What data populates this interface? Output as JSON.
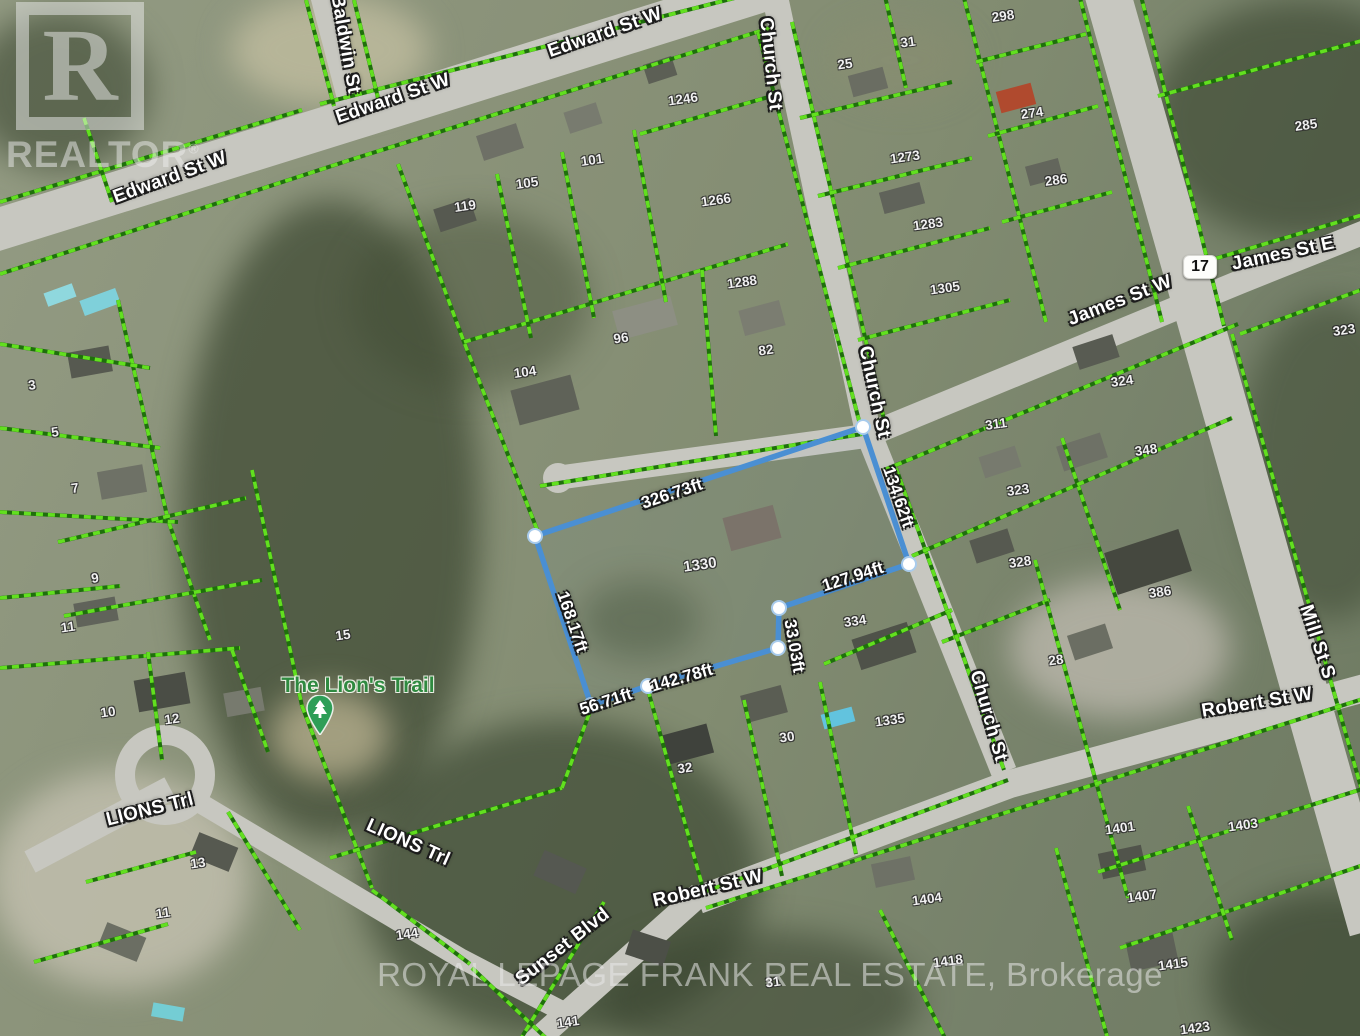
{
  "canvas": {
    "width": 1360,
    "height": 1036
  },
  "colors": {
    "parcel_line_bright": "#62e01f",
    "parcel_line_dark": "#1f6f0c",
    "property_blue": "#4a8fd3",
    "vertex_fill": "#ffffff",
    "vertex_ring": "#a8cbec",
    "road": "#c7c7c0",
    "poi_green": "#2f8a40",
    "pin_green": "#2e9e57"
  },
  "watermarks": {
    "realtor_word": "REALTOR",
    "realtor_reg": "®",
    "realtor_glyph": "R",
    "brokerage_line": "ROYAL LEPAGE FRANK REAL ESTATE, Brokerage"
  },
  "highway_badge": {
    "text": "17",
    "x": 1200,
    "y": 267
  },
  "poi": {
    "label": "The Lion's Trail",
    "x": 358,
    "y": 686,
    "pin_x": 320,
    "pin_y": 740
  },
  "streets": [
    {
      "text": "Edward St W",
      "x": 605,
      "y": 33,
      "rot": -19
    },
    {
      "text": "Edward St W",
      "x": 393,
      "y": 99,
      "rot": -19
    },
    {
      "text": "Edward St W",
      "x": 170,
      "y": 178,
      "rot": -20
    },
    {
      "text": "Baldwin St",
      "x": 345,
      "y": 44,
      "rot": 80
    },
    {
      "text": "Church St",
      "x": 770,
      "y": 64,
      "rot": 84
    },
    {
      "text": "Church St",
      "x": 874,
      "y": 392,
      "rot": 78
    },
    {
      "text": "Church St",
      "x": 988,
      "y": 716,
      "rot": 74
    },
    {
      "text": "James St W",
      "x": 1120,
      "y": 301,
      "rot": -21
    },
    {
      "text": "James St E",
      "x": 1283,
      "y": 254,
      "rot": -12
    },
    {
      "text": "Mill St S",
      "x": 1317,
      "y": 642,
      "rot": 72
    },
    {
      "text": "Robert St W",
      "x": 708,
      "y": 889,
      "rot": -13
    },
    {
      "text": "Robert St W",
      "x": 1257,
      "y": 703,
      "rot": -9
    },
    {
      "text": "Sunset Blvd",
      "x": 563,
      "y": 947,
      "rot": -38
    },
    {
      "text": "LIONS Trl",
      "x": 150,
      "y": 810,
      "rot": -14
    },
    {
      "text": "LIONS Trl",
      "x": 408,
      "y": 843,
      "rot": 24
    }
  ],
  "parcel_numbers": [
    {
      "text": "1246",
      "x": 683,
      "y": 99
    },
    {
      "text": "101",
      "x": 592,
      "y": 160
    },
    {
      "text": "105",
      "x": 527,
      "y": 183
    },
    {
      "text": "119",
      "x": 465,
      "y": 206
    },
    {
      "text": "1266",
      "x": 716,
      "y": 200
    },
    {
      "text": "1288",
      "x": 742,
      "y": 282
    },
    {
      "text": "96",
      "x": 621,
      "y": 338
    },
    {
      "text": "82",
      "x": 766,
      "y": 350
    },
    {
      "text": "104",
      "x": 525,
      "y": 372
    },
    {
      "text": "25",
      "x": 845,
      "y": 64
    },
    {
      "text": "31",
      "x": 908,
      "y": 42
    },
    {
      "text": "1273",
      "x": 905,
      "y": 157
    },
    {
      "text": "1283",
      "x": 928,
      "y": 224
    },
    {
      "text": "1305",
      "x": 945,
      "y": 288
    },
    {
      "text": "298",
      "x": 1003,
      "y": 16
    },
    {
      "text": "274",
      "x": 1032,
      "y": 113
    },
    {
      "text": "286",
      "x": 1056,
      "y": 180
    },
    {
      "text": "285",
      "x": 1306,
      "y": 125
    },
    {
      "text": "323",
      "x": 1344,
      "y": 330
    },
    {
      "text": "324",
      "x": 1122,
      "y": 381
    },
    {
      "text": "311",
      "x": 996,
      "y": 424
    },
    {
      "text": "348",
      "x": 1146,
      "y": 450
    },
    {
      "text": "323",
      "x": 1018,
      "y": 490
    },
    {
      "text": "328",
      "x": 1020,
      "y": 562
    },
    {
      "text": "334",
      "x": 855,
      "y": 621
    },
    {
      "text": "386",
      "x": 1160,
      "y": 592
    },
    {
      "text": "28",
      "x": 1056,
      "y": 660
    },
    {
      "text": "1335",
      "x": 890,
      "y": 720
    },
    {
      "text": "30",
      "x": 787,
      "y": 737
    },
    {
      "text": "32",
      "x": 685,
      "y": 768
    },
    {
      "text": "1404",
      "x": 927,
      "y": 899
    },
    {
      "text": "1418",
      "x": 948,
      "y": 961
    },
    {
      "text": "1401",
      "x": 1120,
      "y": 828
    },
    {
      "text": "1403",
      "x": 1243,
      "y": 825
    },
    {
      "text": "1407",
      "x": 1142,
      "y": 896
    },
    {
      "text": "1415",
      "x": 1173,
      "y": 964
    },
    {
      "text": "1423",
      "x": 1195,
      "y": 1028
    },
    {
      "text": "144",
      "x": 407,
      "y": 934
    },
    {
      "text": "141",
      "x": 568,
      "y": 1022
    },
    {
      "text": "31",
      "x": 773,
      "y": 982
    },
    {
      "text": "15",
      "x": 343,
      "y": 635
    },
    {
      "text": "9",
      "x": 95,
      "y": 578
    },
    {
      "text": "11",
      "x": 68,
      "y": 627
    },
    {
      "text": "10",
      "x": 108,
      "y": 712
    },
    {
      "text": "12",
      "x": 172,
      "y": 719
    },
    {
      "text": "13",
      "x": 198,
      "y": 863
    },
    {
      "text": "11",
      "x": 163,
      "y": 913
    },
    {
      "text": "3",
      "x": 32,
      "y": 385
    },
    {
      "text": "5",
      "x": 55,
      "y": 432
    },
    {
      "text": "7",
      "x": 75,
      "y": 488
    }
  ],
  "property": {
    "parcel_number": {
      "text": "1330",
      "x": 700,
      "y": 565
    },
    "outline": [
      [
        863,
        427
      ],
      [
        909,
        564
      ],
      [
        779,
        608
      ],
      [
        778,
        648
      ],
      [
        648,
        686
      ],
      [
        591,
        705
      ],
      [
        535,
        536
      ]
    ],
    "measurements": [
      {
        "text": "326.73ft",
        "x": 672,
        "y": 494,
        "rot": -18.5
      },
      {
        "text": "134.62ft",
        "x": 898,
        "y": 497,
        "rot": 71
      },
      {
        "text": "127.94ft",
        "x": 853,
        "y": 577,
        "rot": -18
      },
      {
        "text": "33.03ft",
        "x": 794,
        "y": 646,
        "rot": 80
      },
      {
        "text": "142.78ft",
        "x": 682,
        "y": 678,
        "rot": -16
      },
      {
        "text": "56.71ft",
        "x": 606,
        "y": 702,
        "rot": -18
      },
      {
        "text": "168.17ft",
        "x": 572,
        "y": 622,
        "rot": 71
      }
    ]
  },
  "roads": [
    {
      "name": "edward-st-w",
      "pts": [
        [
          -10,
          232
        ],
        [
          350,
          120
        ],
        [
          772,
          -12
        ]
      ],
      "w": 42
    },
    {
      "name": "baldwin-st",
      "pts": [
        [
          320,
          -5
        ],
        [
          348,
          102
        ]
      ],
      "w": 20
    },
    {
      "name": "church-st-north",
      "pts": [
        [
          774,
          -8
        ],
        [
          868,
          432
        ]
      ],
      "w": 26
    },
    {
      "name": "church-st-south",
      "pts": [
        [
          868,
          432
        ],
        [
          1004,
          772
        ]
      ],
      "w": 26
    },
    {
      "name": "james-st",
      "pts": [
        [
          556,
          478
        ],
        [
          866,
          436
        ],
        [
          1240,
          282
        ],
        [
          1370,
          230
        ]
      ],
      "w": 24
    },
    {
      "name": "mill-st-s",
      "pts": [
        [
          1106,
          -12
        ],
        [
          1200,
          320
        ],
        [
          1372,
          930
        ]
      ],
      "w": 46
    },
    {
      "name": "robert-st-w",
      "pts": [
        [
          698,
          900
        ],
        [
          1010,
          784
        ],
        [
          1372,
          686
        ]
      ],
      "w": 28
    },
    {
      "name": "sunset-blvd",
      "pts": [
        [
          530,
          1046
        ],
        [
          700,
          894
        ]
      ],
      "w": 24
    },
    {
      "name": "lions-trl-west",
      "pts": [
        [
          30,
          862
        ],
        [
          170,
          788
        ]
      ],
      "w": 24
    },
    {
      "name": "lions-trl-east",
      "pts": [
        [
          195,
          800
        ],
        [
          460,
          958
        ],
        [
          560,
          1010
        ]
      ],
      "w": 20
    }
  ],
  "road_circles": [
    {
      "name": "lions-culdesac",
      "cx": 165,
      "cy": 775,
      "r": 40,
      "ring": true
    },
    {
      "name": "james-stub",
      "cx": 558,
      "cy": 478,
      "r": 15,
      "ring": false
    }
  ],
  "parcel_lines": [
    [
      [
        0,
        274
      ],
      [
        350,
        160
      ],
      [
        770,
        28
      ]
    ],
    [
      [
        0,
        202
      ],
      [
        302,
        110
      ]
    ],
    [
      [
        320,
        104
      ],
      [
        766,
        -10
      ]
    ],
    [
      [
        306,
        0
      ],
      [
        334,
        106
      ]
    ],
    [
      [
        354,
        0
      ],
      [
        378,
        98
      ]
    ],
    [
      [
        84,
        118
      ],
      [
        112,
        202
      ]
    ],
    [
      [
        398,
        164
      ],
      [
        464,
        342
      ],
      [
        538,
        532
      ]
    ],
    [
      [
        464,
        342
      ],
      [
        702,
        270
      ],
      [
        788,
        244
      ]
    ],
    [
      [
        497,
        174
      ],
      [
        531,
        338
      ]
    ],
    [
      [
        562,
        152
      ],
      [
        594,
        318
      ]
    ],
    [
      [
        634,
        130
      ],
      [
        666,
        302
      ]
    ],
    [
      [
        640,
        134
      ],
      [
        772,
        96
      ]
    ],
    [
      [
        702,
        270
      ],
      [
        716,
        436
      ]
    ],
    [
      [
        758,
        32
      ],
      [
        862,
        432
      ]
    ],
    [
      [
        540,
        486
      ],
      [
        862,
        434
      ]
    ],
    [
      [
        792,
        22
      ],
      [
        886,
        428
      ]
    ],
    [
      [
        896,
        468
      ],
      [
        1004,
        770
      ]
    ],
    [
      [
        884,
        -8
      ],
      [
        906,
        88
      ]
    ],
    [
      [
        800,
        118
      ],
      [
        952,
        82
      ]
    ],
    [
      [
        818,
        196
      ],
      [
        972,
        158
      ]
    ],
    [
      [
        838,
        268
      ],
      [
        990,
        228
      ]
    ],
    [
      [
        858,
        340
      ],
      [
        1010,
        300
      ]
    ],
    [
      [
        962,
        -10
      ],
      [
        1046,
        322
      ]
    ],
    [
      [
        976,
        62
      ],
      [
        1086,
        34
      ]
    ],
    [
      [
        988,
        136
      ],
      [
        1098,
        106
      ]
    ],
    [
      [
        1002,
        222
      ],
      [
        1112,
        192
      ]
    ],
    [
      [
        1078,
        -10
      ],
      [
        1162,
        322
      ]
    ],
    [
      [
        1140,
        -8
      ],
      [
        1224,
        326
      ]
    ],
    [
      [
        1158,
        96
      ],
      [
        1372,
        38
      ]
    ],
    [
      [
        1204,
        262
      ],
      [
        1372,
        212
      ]
    ],
    [
      [
        1240,
        334
      ],
      [
        1372,
        286
      ]
    ],
    [
      [
        1232,
        334
      ],
      [
        1372,
        826
      ]
    ],
    [
      [
        884,
        470
      ],
      [
        1238,
        324
      ]
    ],
    [
      [
        1062,
        438
      ],
      [
        1120,
        610
      ]
    ],
    [
      [
        912,
        556
      ],
      [
        1232,
        418
      ]
    ],
    [
      [
        942,
        642
      ],
      [
        1050,
        600
      ]
    ],
    [
      [
        1035,
        560
      ],
      [
        1128,
        898
      ]
    ],
    [
      [
        824,
        664
      ],
      [
        952,
        610
      ]
    ],
    [
      [
        948,
        612
      ],
      [
        990,
        734
      ]
    ],
    [
      [
        648,
        690
      ],
      [
        704,
        892
      ]
    ],
    [
      [
        744,
        700
      ],
      [
        782,
        876
      ]
    ],
    [
      [
        820,
        682
      ],
      [
        856,
        854
      ]
    ],
    [
      [
        704,
        892
      ],
      [
        1008,
        780
      ]
    ],
    [
      [
        706,
        908
      ],
      [
        1372,
        696
      ]
    ],
    [
      [
        880,
        910
      ],
      [
        946,
        1040
      ]
    ],
    [
      [
        1056,
        848
      ],
      [
        1108,
        1040
      ]
    ],
    [
      [
        1098,
        872
      ],
      [
        1372,
        786
      ]
    ],
    [
      [
        1120,
        948
      ],
      [
        1372,
        862
      ]
    ],
    [
      [
        1188,
        806
      ],
      [
        1232,
        940
      ]
    ],
    [
      [
        118,
        300
      ],
      [
        168,
        520
      ],
      [
        210,
        640
      ]
    ],
    [
      [
        0,
        344
      ],
      [
        150,
        368
      ]
    ],
    [
      [
        0,
        428
      ],
      [
        160,
        448
      ]
    ],
    [
      [
        0,
        512
      ],
      [
        178,
        522
      ]
    ],
    [
      [
        0,
        598
      ],
      [
        120,
        586
      ]
    ],
    [
      [
        58,
        542
      ],
      [
        246,
        498
      ]
    ],
    [
      [
        64,
        616
      ],
      [
        262,
        580
      ]
    ],
    [
      [
        252,
        470
      ],
      [
        302,
        706
      ]
    ],
    [
      [
        0,
        668
      ],
      [
        240,
        648
      ]
    ],
    [
      [
        148,
        652
      ],
      [
        162,
        760
      ]
    ],
    [
      [
        232,
        650
      ],
      [
        268,
        752
      ]
    ],
    [
      [
        302,
        706
      ],
      [
        372,
        888
      ]
    ],
    [
      [
        228,
        812
      ],
      [
        300,
        930
      ]
    ],
    [
      [
        86,
        882
      ],
      [
        196,
        852
      ]
    ],
    [
      [
        34,
        962
      ],
      [
        168,
        924
      ]
    ],
    [
      [
        372,
        890
      ],
      [
        470,
        964
      ]
    ],
    [
      [
        330,
        858
      ],
      [
        562,
        788
      ]
    ],
    [
      [
        562,
        788
      ],
      [
        592,
        706
      ]
    ],
    [
      [
        472,
        968
      ],
      [
        548,
        1040
      ]
    ],
    [
      [
        604,
        902
      ],
      [
        520,
        1040
      ]
    ]
  ]
}
